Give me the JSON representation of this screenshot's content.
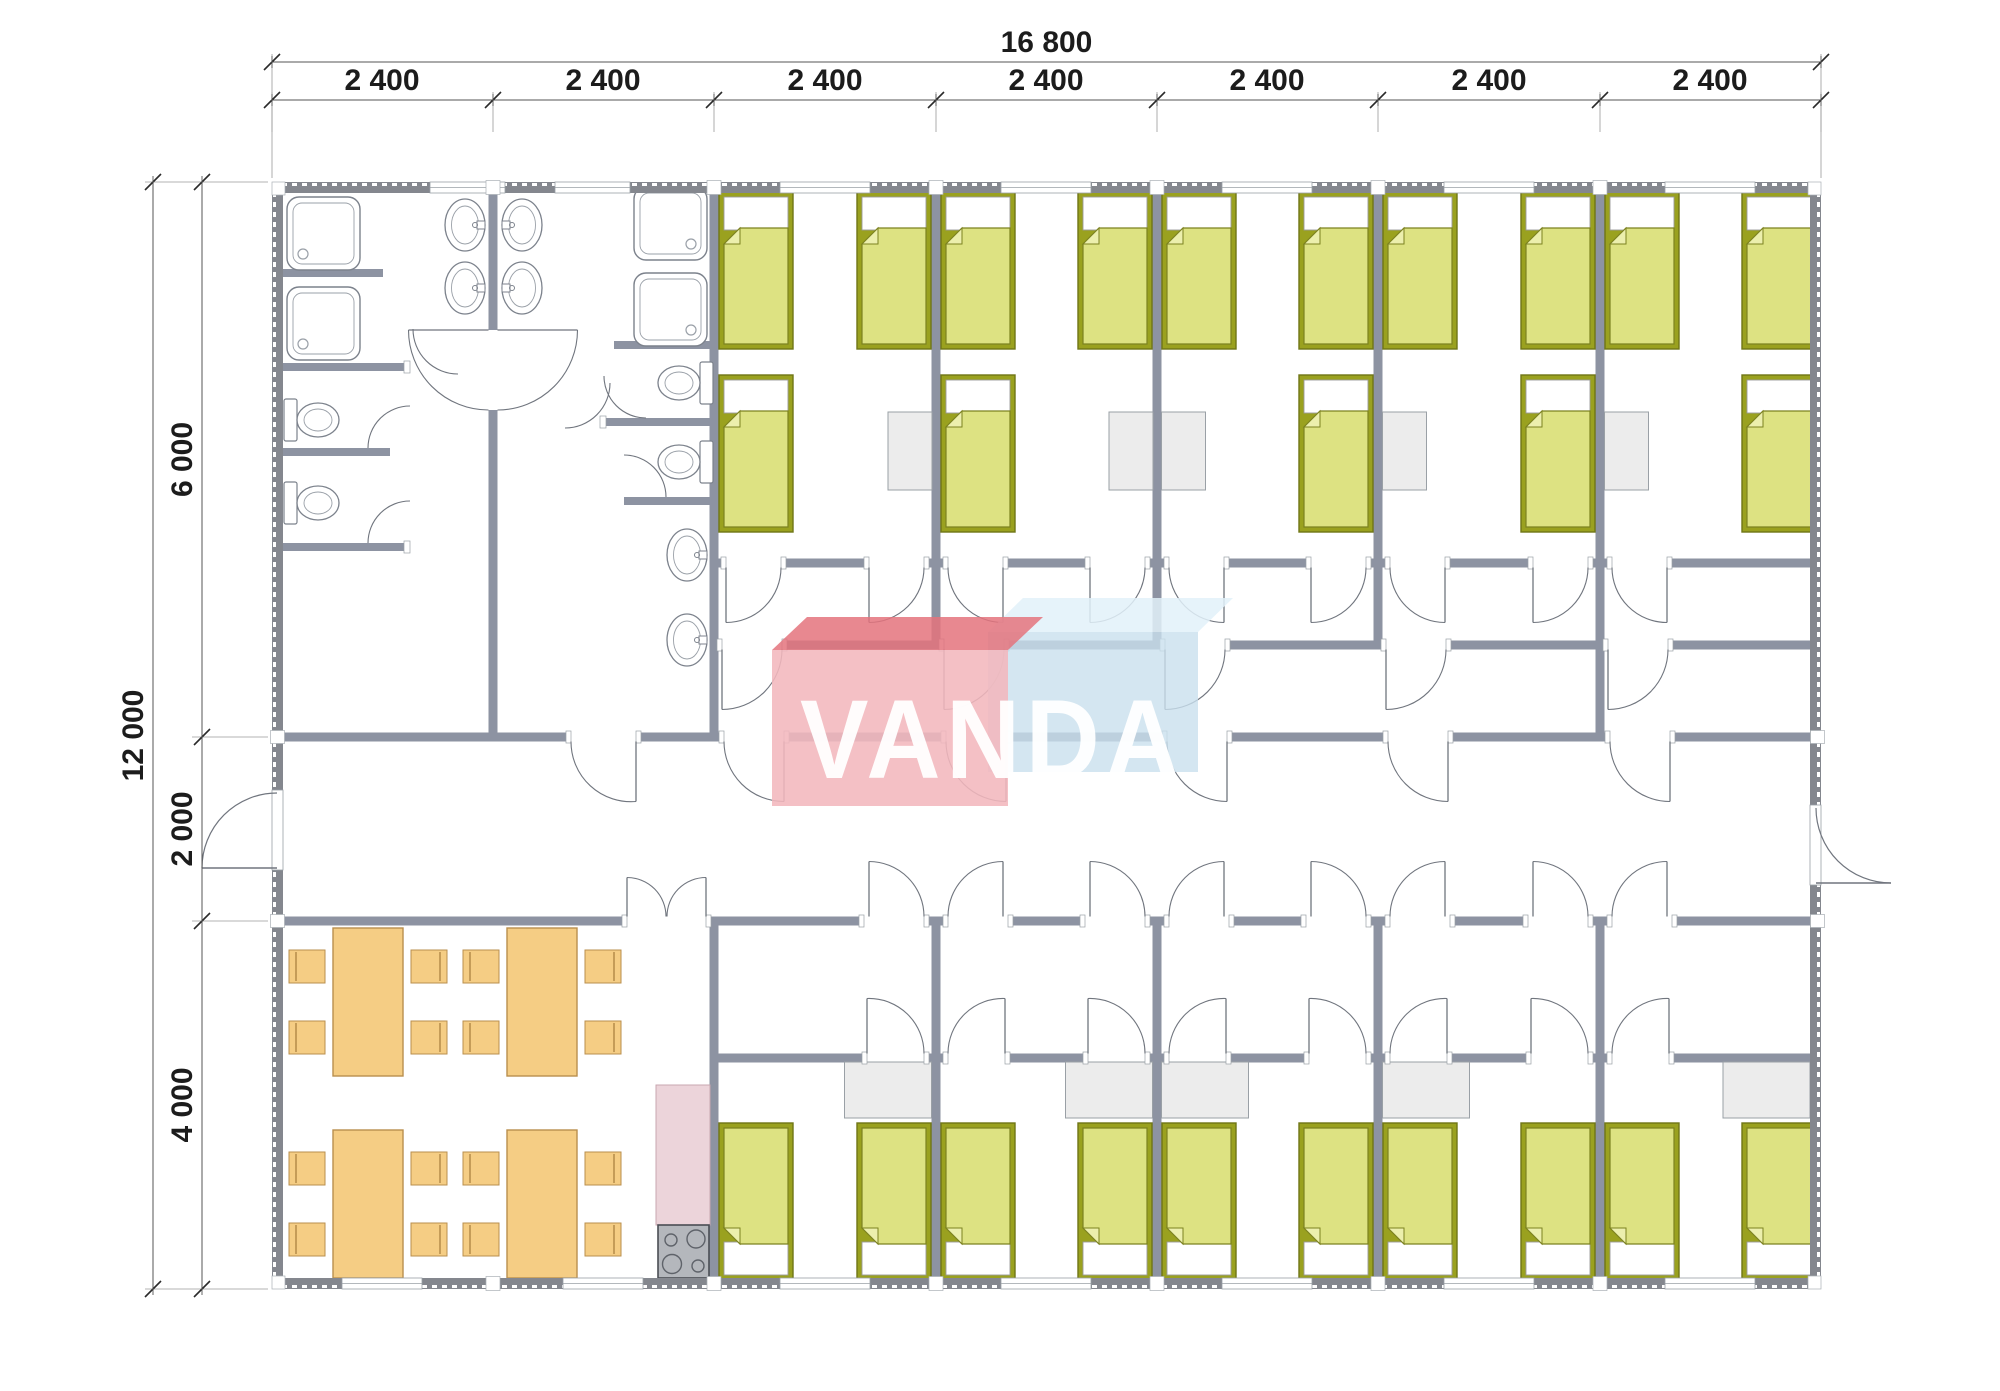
{
  "drawing": {
    "type": "modular-building-floor-plan",
    "watermark_text": "VANDA"
  },
  "dimensions": {
    "overall_width_label": "16 800",
    "module_labels": [
      "2 400",
      "2 400",
      "2 400",
      "2 400",
      "2 400",
      "2 400",
      "2 400"
    ],
    "overall_height_label": "12 000",
    "height_segment_labels": [
      "6 000",
      "2 000",
      "4 000"
    ]
  },
  "watermark": {
    "text": "VANDA",
    "front_color": "#f3b7bd",
    "front_edge_color": "#e4737c",
    "back_color": "#c9e0ee",
    "back_edge_color": "#e2f1f9",
    "text_color": "#ffffff"
  },
  "palette": {
    "wall": "#8d93a2",
    "wall_outer": "#84878e",
    "bed_frame": "#9aa11f",
    "bed_frame_stroke": "#6f7616",
    "blanket": "#dde282",
    "blanket_stroke": "#7c8220",
    "blanket_fold": "#ecefad",
    "pillow": "#ffffff",
    "desk": "#ececec",
    "desk_stroke": "#9aa0a6",
    "table": "#f5cd84",
    "table_stroke": "#b98f4e",
    "counter": "#ecd4da",
    "counter_stroke": "#c9a7b0",
    "stove": "#b4b7bc",
    "stove_stroke": "#4a4e54",
    "fixture_stroke": "#7c828c",
    "door_stroke": "#70757e",
    "dim_text": "#1c1c1c",
    "dim_line": "#555555",
    "ext_line": "#9a9a9a"
  },
  "inventory": {
    "sleeping_rooms_top_row": 5,
    "sleeping_rooms_bottom_row": 5,
    "beds_total": 25,
    "showers": 4,
    "toilets": 4,
    "washbasins": 6,
    "dining_tables": 4,
    "dining_chairs": 16,
    "desks": 10,
    "kitchen_stoves": 1
  }
}
